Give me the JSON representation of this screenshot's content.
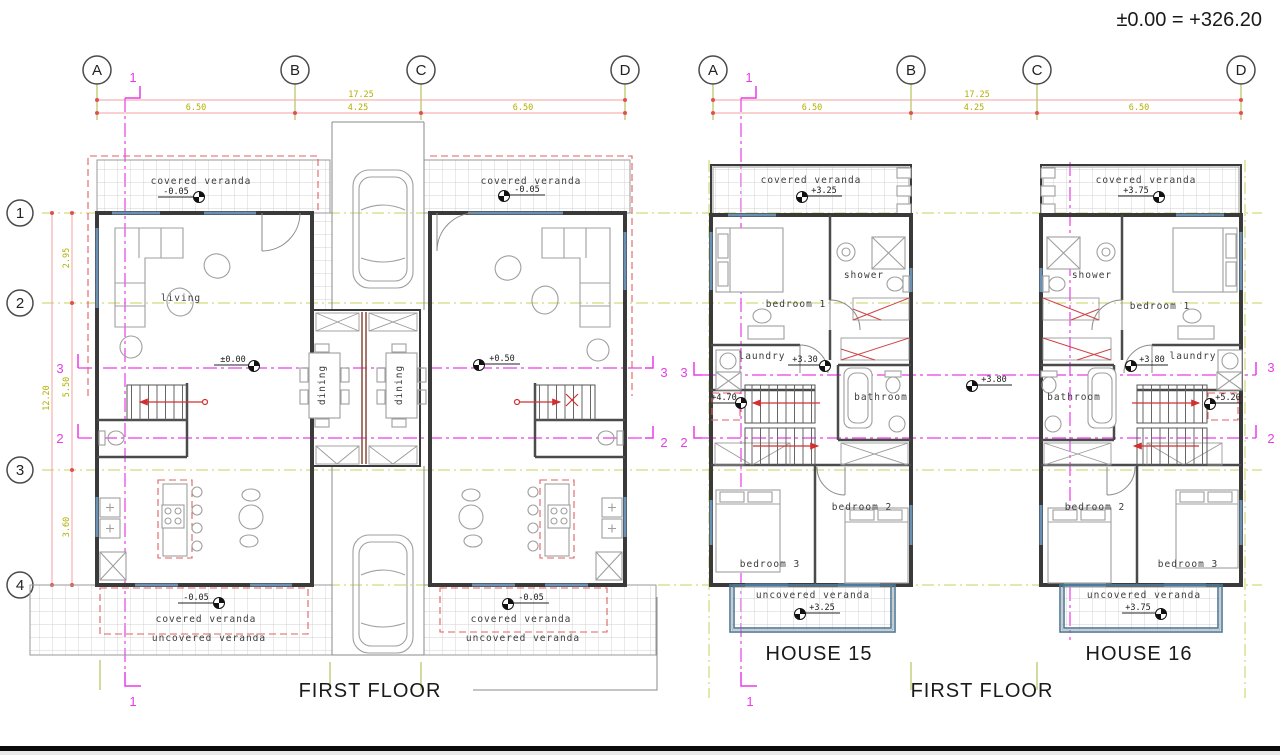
{
  "header": {
    "datum_note": "±0.00 = +326.20"
  },
  "shared": {
    "grid_cols": [
      "A",
      "B",
      "C",
      "D"
    ],
    "dim_total": "17.25",
    "dim_segments": [
      "6.50",
      "4.25",
      "6.50"
    ],
    "floor_title": "FIRST FLOOR",
    "section_1": "1",
    "section_2": "2",
    "section_3": "3"
  },
  "ground_plan": {
    "grid_rows": [
      "1",
      "2",
      "3",
      "4"
    ],
    "vdim_total": "12.20",
    "vdim_segments": [
      "2.95",
      "5.50",
      "3.60"
    ],
    "unit_a": {
      "veranda_top_label": "covered veranda",
      "veranda_top_level": "-0.05",
      "living_label": "living",
      "floor_level": "±0.00",
      "dining_label": "dining",
      "veranda_bottom_level": "-0.05",
      "veranda_bottom_label": "covered veranda",
      "uncovered_label": "uncovered veranda"
    },
    "unit_b": {
      "veranda_top_label": "covered veranda",
      "veranda_top_level": "-0.05",
      "floor_level": "+0.50",
      "dining_label": "dining",
      "veranda_bottom_level": "-0.05",
      "veranda_bottom_label": "covered veranda",
      "uncovered_label": "uncovered veranda"
    }
  },
  "upper_plan": {
    "house15": {
      "name": "HOUSE 15",
      "veranda_top_label": "covered veranda",
      "veranda_top_level": "+3.25",
      "bedroom1_label": "bedroom 1",
      "shower_label": "shower",
      "laundry_label": "laundry",
      "hall_level": "+3.30",
      "stair_level": "+4.70",
      "bathroom_label": "bathroom",
      "bedroom2_label": "bedroom 2",
      "bedroom3_label": "bedroom 3",
      "veranda_bottom_label": "uncovered veranda",
      "veranda_bottom_level": "+3.25"
    },
    "house16": {
      "name": "HOUSE 16",
      "veranda_top_label": "covered veranda",
      "veranda_top_level": "+3.75",
      "bedroom1_label": "bedroom 1",
      "shower_label": "shower",
      "laundry_label": "laundry",
      "hall_level": "+3.80",
      "stair_level": "+5.20",
      "bathroom_label": "bathroom",
      "bedroom2_label": "bedroom 2",
      "bedroom3_label": "bedroom 3",
      "veranda_bottom_label": "uncovered veranda",
      "veranda_bottom_level": "+3.75"
    },
    "between_level": "+3.80"
  }
}
